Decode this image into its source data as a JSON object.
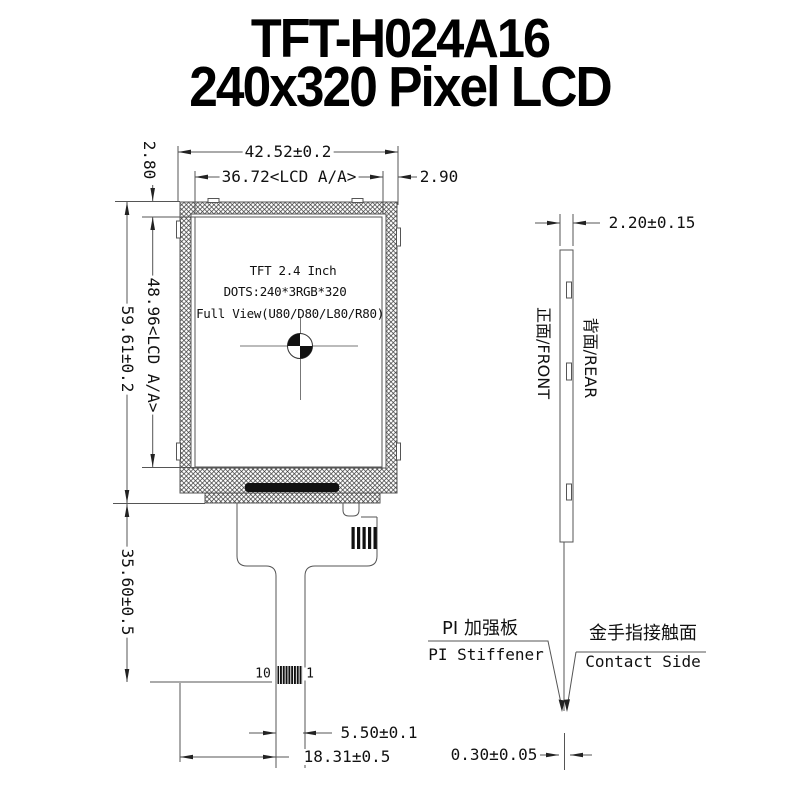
{
  "title": {
    "line1": "TFT-H024A16",
    "line2": "240x320 Pixel LCD"
  },
  "front_view": {
    "display": {
      "line1": "TFT 2.4 Inch",
      "line2": "DOTS:240*3RGB*320",
      "line3": "Full View(U80/D80/L80/R80)"
    },
    "pins": {
      "left": "10",
      "right": "1"
    },
    "dims": {
      "outline_width": "42.52±0.2",
      "active_width": "36.72<LCD A/A>",
      "right_margin": "2.90",
      "top_margin": "2.80",
      "active_height": "48.96<LCD A/A>",
      "outline_height": "59.61±0.2",
      "fpc_length": "35.60±0.5",
      "tail_width": "5.50±0.1",
      "tail_offset": "18.31±0.5"
    }
  },
  "side_view": {
    "dims": {
      "thickness": "2.20±0.15",
      "contact_thickness": "0.30±0.05"
    },
    "labels": {
      "front": "正面/FRONT",
      "rear": "背面/REAR"
    },
    "callouts": {
      "stiffener_cn": "PI 加强板",
      "stiffener_en": "PI Stiffener",
      "contact_cn": "金手指接触面",
      "contact_en": "Contact Side"
    }
  },
  "colors": {
    "line": "#555555",
    "ink": "#111111",
    "background": "#ffffff"
  }
}
